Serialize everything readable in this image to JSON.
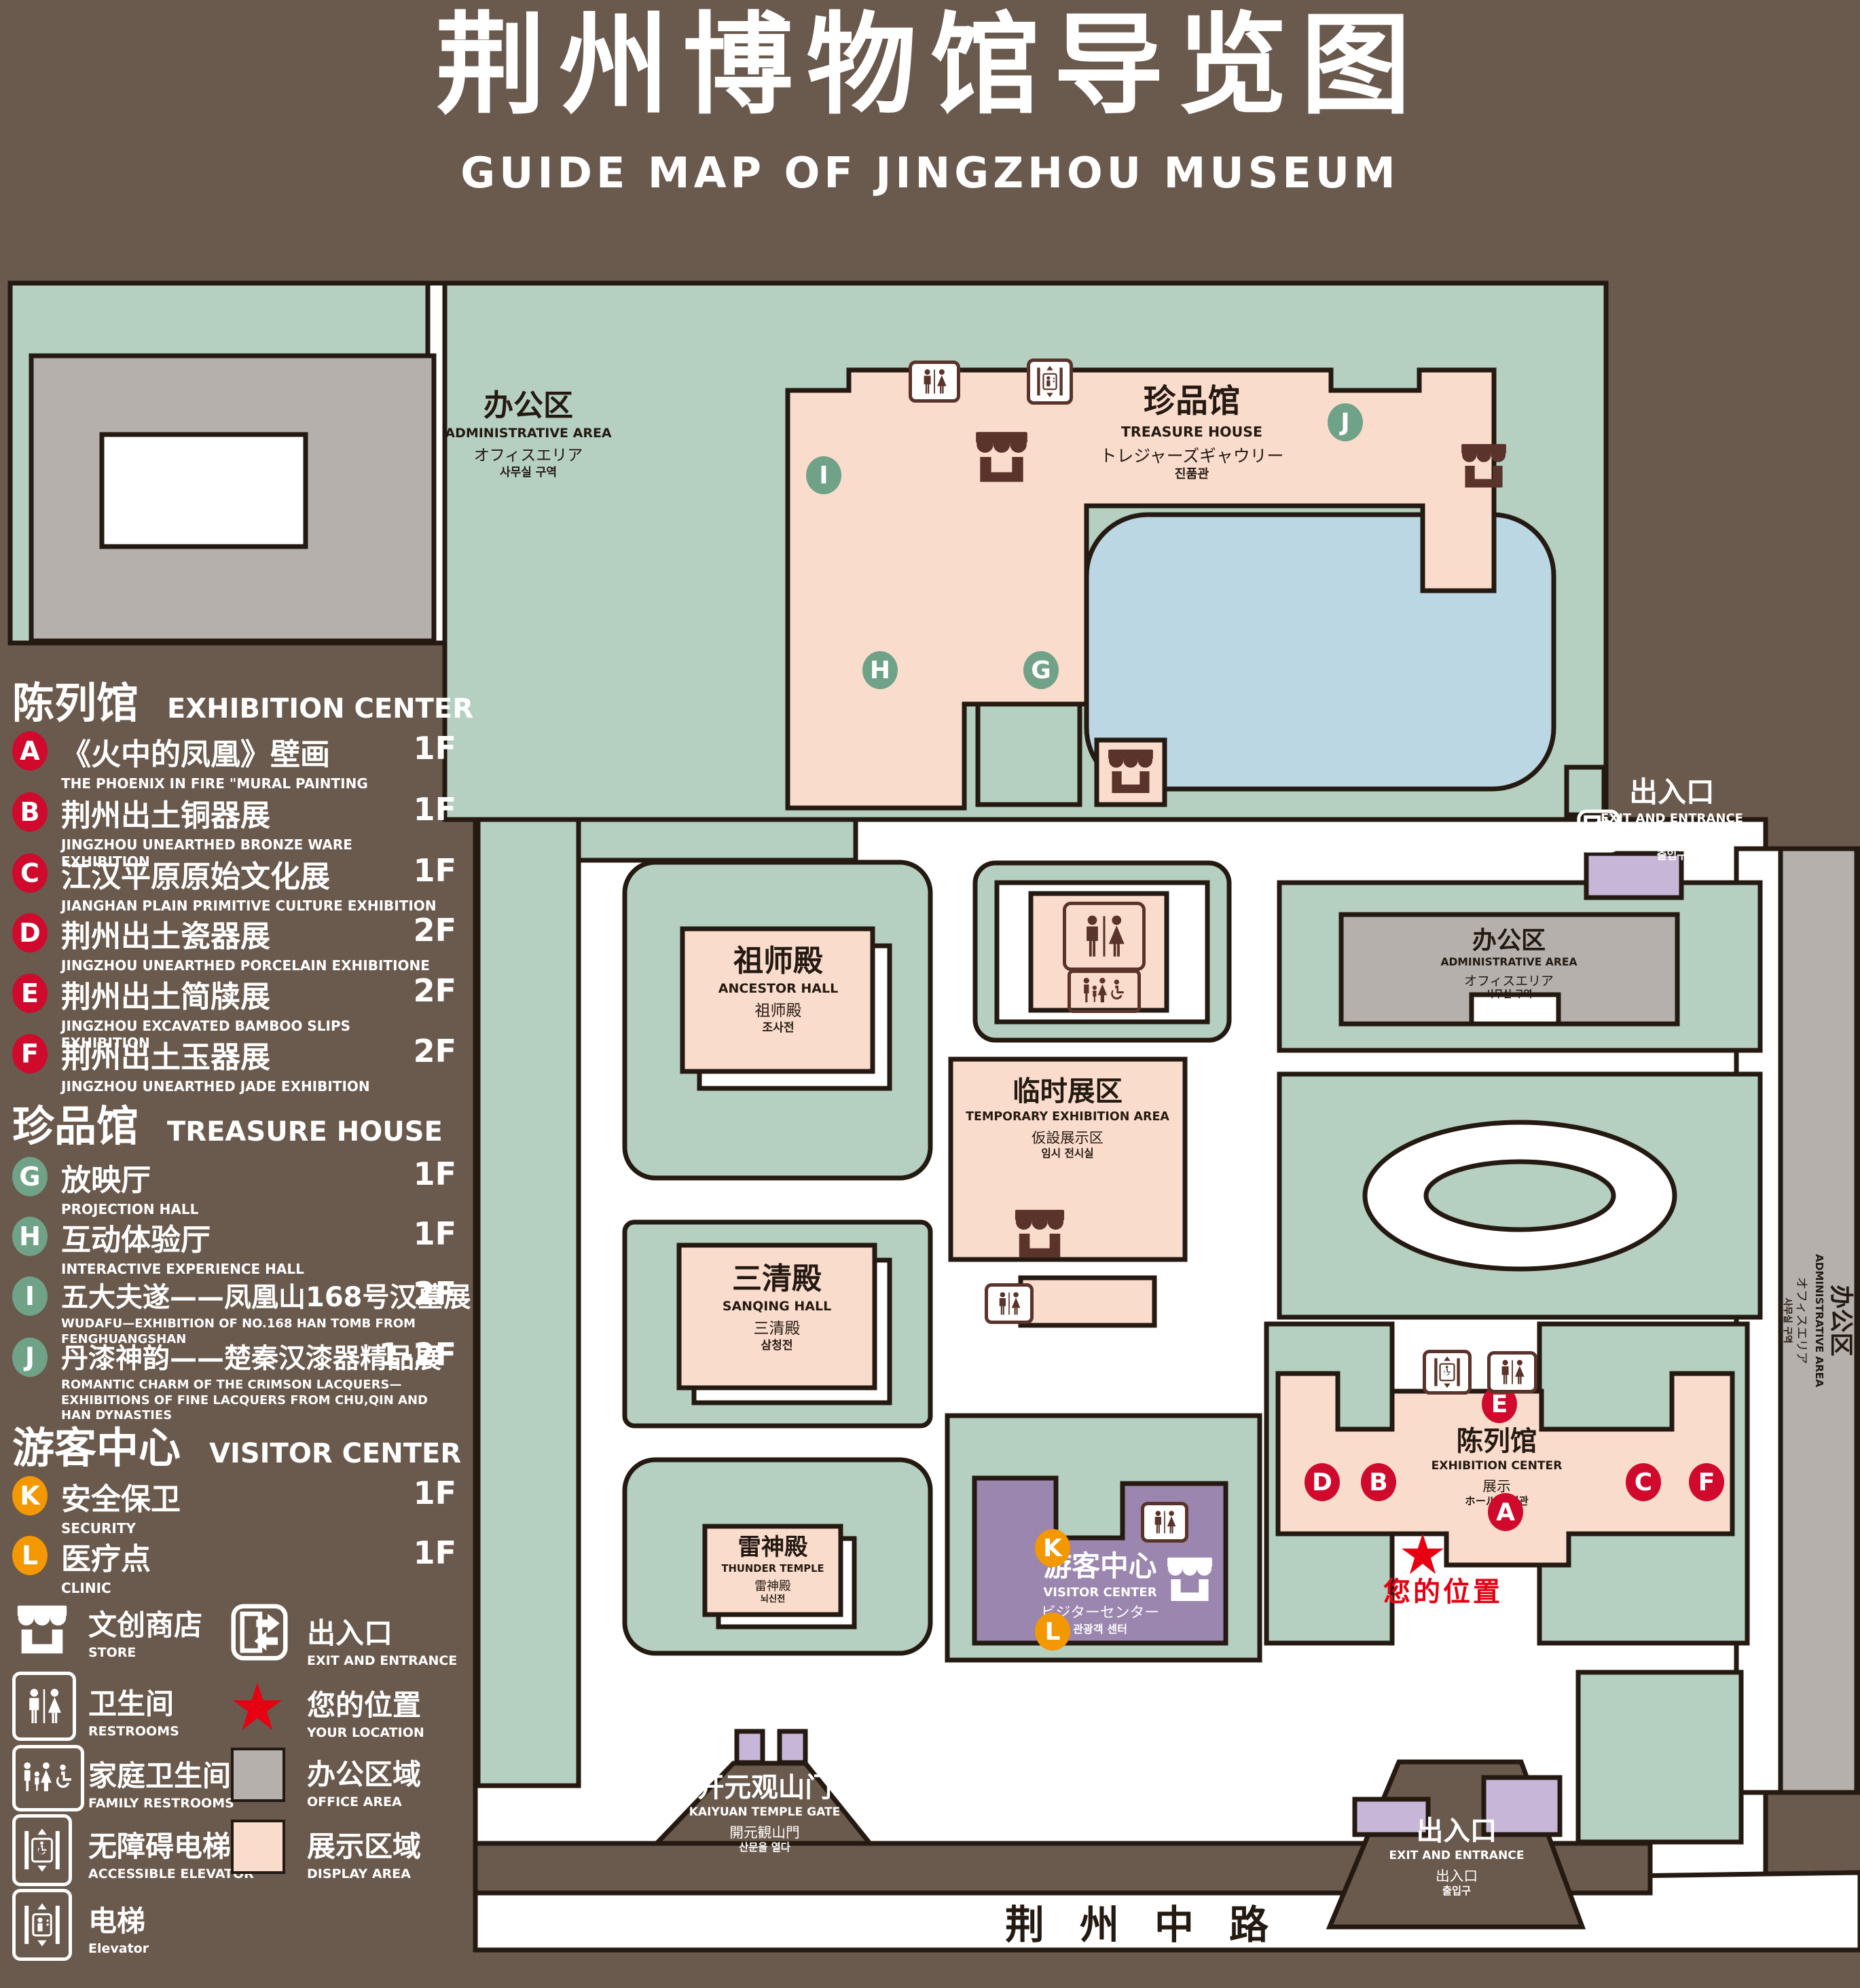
{
  "title": {
    "zh": "荆州博物馆导览图",
    "en": "GUIDE MAP OF JINGZHOU MUSEUM"
  },
  "legend": {
    "sections": [
      {
        "header_zh": "陈列馆",
        "header_en": "EXHIBITION CENTER",
        "items": [
          {
            "letter": "A",
            "zh": "《火中的凤凰》壁画",
            "en": "THE PHOENIX IN FIRE \"MURAL PAINTING",
            "floor": "1F"
          },
          {
            "letter": "B",
            "zh": "荆州出土铜器展",
            "en": "JINGZHOU UNEARTHED BRONZE WARE EXHIBITION",
            "floor": "1F"
          },
          {
            "letter": "C",
            "zh": "江汉平原原始文化展",
            "en": "JIANGHAN PLAIN PRIMITIVE CULTURE EXHIBITION",
            "floor": "1F"
          },
          {
            "letter": "D",
            "zh": "荆州出土瓷器展",
            "en": "JINGZHOU UNEARTHED PORCELAIN EXHIBITIONE",
            "floor": "2F"
          },
          {
            "letter": "E",
            "zh": "荆州出土简牍展",
            "en": "JINGZHOU EXCAVATED BAMBOO SLIPS EXHIBITION",
            "floor": "2F"
          },
          {
            "letter": "F",
            "zh": "荆州出土玉器展",
            "en": "JINGZHOU UNEARTHED JADE EXHIBITION",
            "floor": "2F"
          }
        ]
      },
      {
        "header_zh": "珍品馆",
        "header_en": "TREASURE HOUSE",
        "items": [
          {
            "letter": "G",
            "zh": "放映厅",
            "en": "PROJECTION HALL",
            "floor": "1F"
          },
          {
            "letter": "H",
            "zh": "互动体验厅",
            "en": "INTERACTIVE EXPERIENCE HALL",
            "floor": "1F"
          },
          {
            "letter": "I",
            "zh": "五大夫遂——凤凰山168号汉墓展",
            "en": "WUDAFU—EXHIBITION OF NO.168 HAN TOMB FROM FENGHUANGSHAN",
            "floor": "2F"
          },
          {
            "letter": "J",
            "zh": "丹漆神韵——楚秦汉漆器精品展",
            "en": "ROMANTIC CHARM OF THE CRIMSON LACQUERS—EXHIBITIONS OF FINE LACQUERS FROM CHU,QIN AND HAN DYNASTIES",
            "floor": "1-2F"
          }
        ]
      },
      {
        "header_zh": "游客中心",
        "header_en": "VISITOR CENTER",
        "items": [
          {
            "letter": "K",
            "zh": "安全保卫",
            "en": "SECURITY",
            "floor": "1F"
          },
          {
            "letter": "L",
            "zh": "医疗点",
            "en": "CLINIC",
            "floor": "1F"
          }
        ]
      }
    ],
    "symbols": [
      {
        "icon": "store-icon",
        "zh": "文创商店",
        "en": "STORE"
      },
      {
        "icon": "restroom-icon",
        "zh": "卫生间",
        "en": "RESTROOMS"
      },
      {
        "icon": "family-restroom-icon",
        "zh": "家庭卫生间",
        "en": "FAMILY RESTROOMS"
      },
      {
        "icon": "accessible-elevator-icon",
        "zh": "无障碍电梯",
        "en": "ACCESSIBLE ELEVATOR"
      },
      {
        "icon": "elevator-icon",
        "zh": "电梯",
        "en": "Elevator"
      },
      {
        "icon": "exit-icon",
        "zh": "出入口",
        "en": "EXIT AND ENTRANCE"
      },
      {
        "icon": "location-star-icon",
        "zh": "您的位置",
        "en": "YOUR LOCATION"
      },
      {
        "icon": "office-swatch",
        "zh": "办公区域",
        "en": "OFFICE AREA"
      },
      {
        "icon": "display-swatch",
        "zh": "展示区域",
        "en": "DISPLAY AREA"
      }
    ]
  },
  "map": {
    "admin_top": {
      "zh": "办公区",
      "en": "ADMINISTRATIVE AREA",
      "ja": "オフィスエリア",
      "ko": "사무실 구역"
    },
    "treasure": {
      "zh": "珍品馆",
      "en": "TREASURE HOUSE",
      "ja": "トレジャーズギャウリー",
      "ko": "진품관"
    },
    "ancestor": {
      "zh": "祖师殿",
      "en": "ANCESTOR HALL",
      "ja": "祖师殿",
      "ko": "조사전"
    },
    "temporary": {
      "zh": "临时展区",
      "en": "TEMPORARY EXHIBITION AREA",
      "ja": "仮設展示区",
      "ko": "임시 전시실"
    },
    "sanqing": {
      "zh": "三清殿",
      "en": "SANQING HALL",
      "ja": "三清殿",
      "ko": "삼청전"
    },
    "thunder": {
      "zh": "雷神殿",
      "en": "THUNDER TEMPLE",
      "ja": "雷神殿",
      "ko": "뇌신전"
    },
    "visitor": {
      "zh": "游客中心",
      "en": "VISITOR CENTER",
      "ja": "ビジターセンター",
      "ko": "관광객 센터"
    },
    "exhibition": {
      "zh": "陈列馆",
      "en": "EXHIBITION CENTER",
      "ja": "展示",
      "ko": "ホール 진열관"
    },
    "admin_mid": {
      "zh": "办公区",
      "en": "ADMINISTRATIVE AREA",
      "ja": "オフィスエリア",
      "ko": "사무실 구역"
    },
    "admin_right": {
      "zh": "办公区",
      "en": "ADMINISTRATIVE AREA",
      "ja": "オフィスエリア",
      "ko": "사무실 구역"
    },
    "gate": {
      "zh": "开元观山门",
      "en": "KAIYUAN TEMPLE GATE",
      "ja": "開元観山門",
      "ko": "산문을 열다"
    },
    "exit_top": {
      "zh": "出入口",
      "en": "EXIT AND ENTRANCE",
      "ja": "出入口",
      "ko": "출입구"
    },
    "exit_bottom": {
      "zh": "出入口",
      "en": "EXIT AND ENTRANCE",
      "ja": "出入口",
      "ko": "출입구"
    },
    "road": "荆州中路",
    "your_location": "您的位置",
    "markers": {
      "A": "A",
      "B": "B",
      "C": "C",
      "D": "D",
      "E": "E",
      "F": "F",
      "G": "G",
      "H": "H",
      "I": "I",
      "J": "J",
      "K": "K",
      "L": "L"
    }
  },
  "colors": {
    "background": "#6a594d",
    "green": "#b5cfc0",
    "pink": "#fadccd",
    "gray": "#b5b0ac",
    "pond_blue": "#bad7e3",
    "purple": "#9a86ae",
    "purple_light": "#c8b6d8",
    "marker_red": "#cf0a2c",
    "marker_green": "#6fa287",
    "marker_orange": "#f39800",
    "icon_brown": "#5a332a",
    "star_red": "#e60012",
    "outline": "#241a12"
  }
}
